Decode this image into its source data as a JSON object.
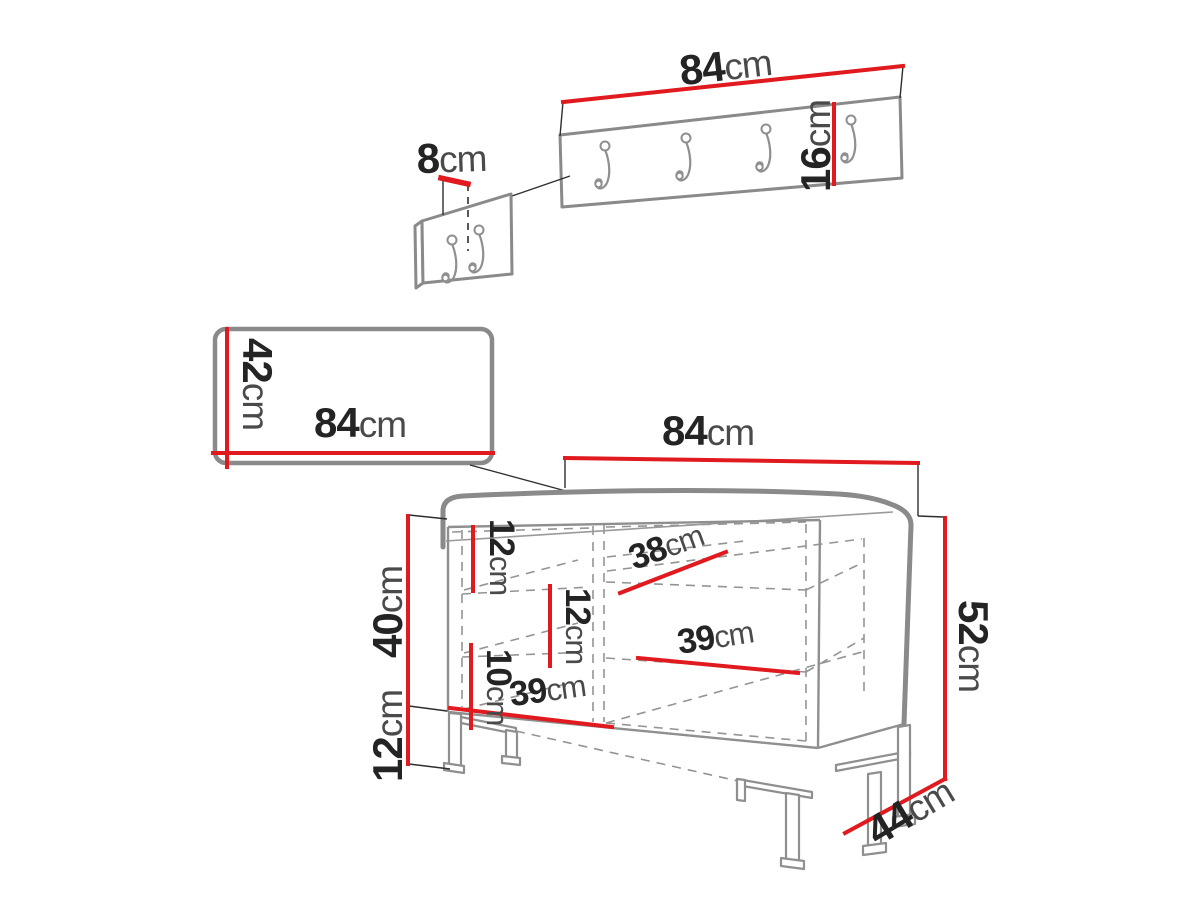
{
  "diagram": {
    "title": "hallway furniture set dimension drawing",
    "units": "cm",
    "colors": {
      "dimension_red": "#e01a1e",
      "outline_gray": "#8a8a8a",
      "text_dark": "#242424"
    },
    "rack": {
      "label": "wall coat rack panel",
      "hook_count": 4,
      "width": {
        "v": "84",
        "u": "cm"
      },
      "height": {
        "v": "16",
        "u": "cm"
      }
    },
    "hook_detail": {
      "label": "hook spacing detail panel",
      "hook_count": 2,
      "spacing": {
        "v": "8",
        "u": "cm"
      }
    },
    "mirror": {
      "label": "mirror panel",
      "width": {
        "v": "84",
        "u": "cm"
      },
      "height": {
        "v": "42",
        "u": "cm"
      }
    },
    "bench": {
      "label": "shoe storage bench",
      "width": {
        "v": "84",
        "u": "cm"
      },
      "total_height": {
        "v": "52",
        "u": "cm"
      },
      "depth": {
        "v": "44",
        "u": "cm"
      },
      "cabinet_height": {
        "v": "40",
        "u": "cm"
      },
      "leg_height": {
        "v": "12",
        "u": "cm"
      },
      "compartment_top": {
        "v": "12",
        "u": "cm"
      },
      "compartment_middle": {
        "v": "12",
        "u": "cm"
      },
      "compartment_bottom": {
        "v": "10",
        "u": "cm"
      },
      "shelf_top_width": {
        "v": "38",
        "u": "cm"
      },
      "shelf_middle_width": {
        "v": "39",
        "u": "cm"
      },
      "shelf_bottom_width": {
        "v": "39",
        "u": "cm"
      }
    }
  }
}
